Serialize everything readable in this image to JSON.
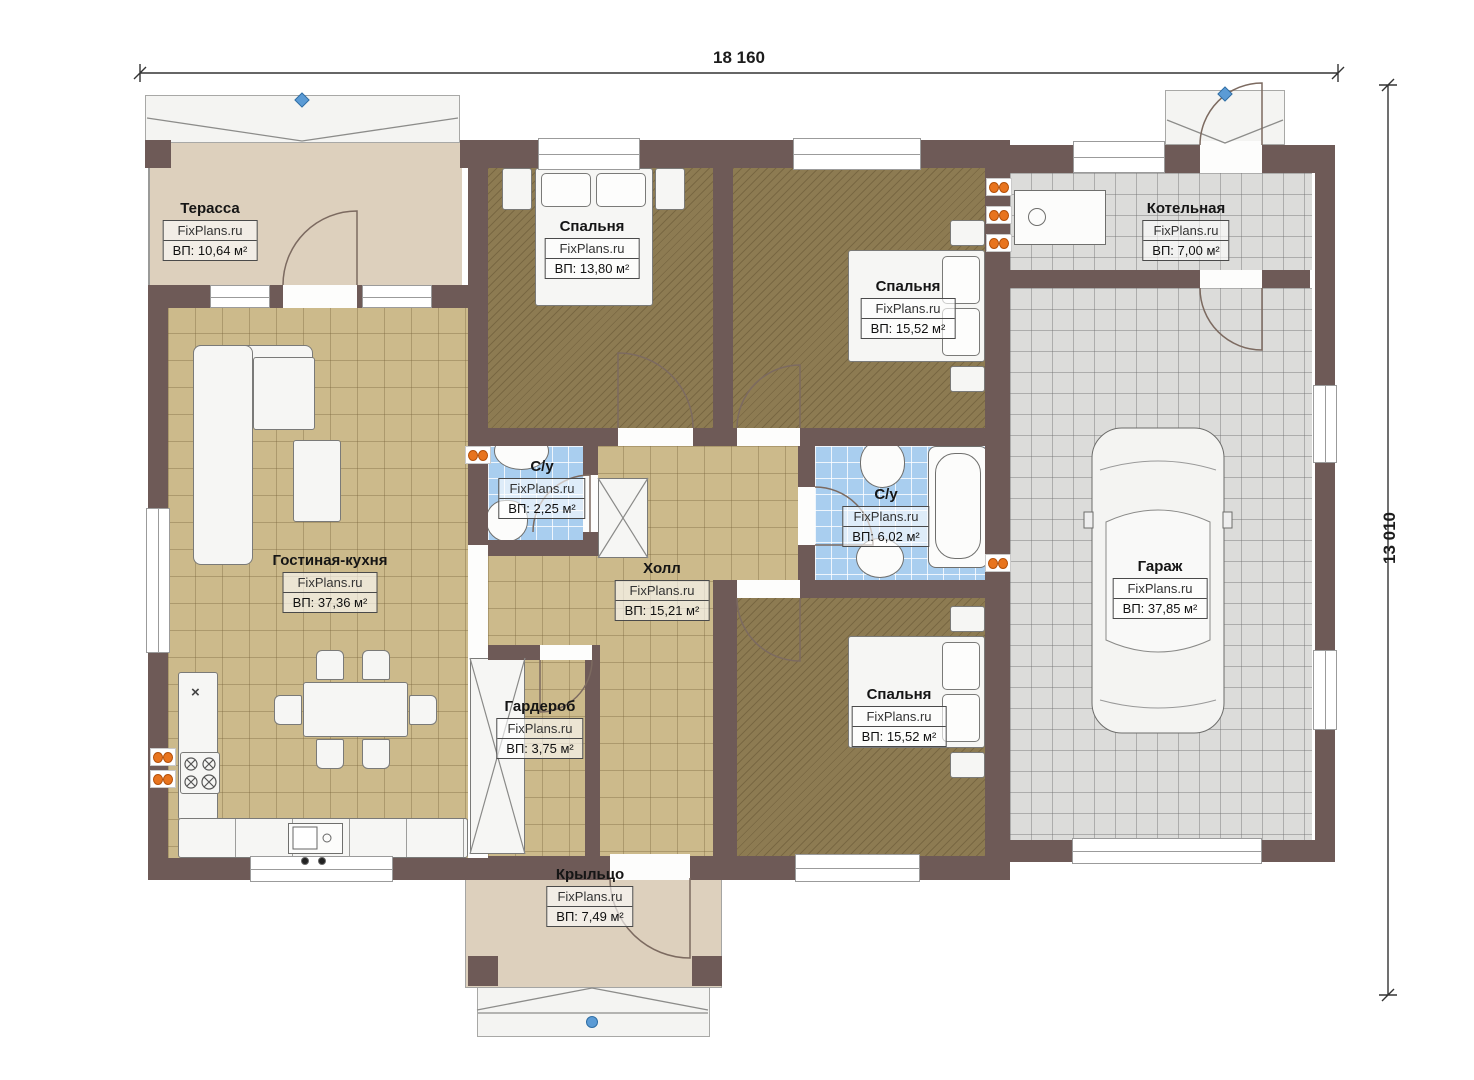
{
  "brand": "FixPlans.ru",
  "dimensions": {
    "width_label": "18 160",
    "height_label": "13 010"
  },
  "rooms": {
    "terrace": {
      "name": "Терасса",
      "area": "ВП: 10,64 м²"
    },
    "living": {
      "name": "Гостиная-кухня",
      "area": "ВП: 37,36 м²"
    },
    "bedroom1": {
      "name": "Спальня",
      "area": "ВП: 13,80 м²"
    },
    "bedroom2": {
      "name": "Спальня",
      "area": "ВП: 15,52 м²"
    },
    "boiler": {
      "name": "Котельная",
      "area": "ВП: 7,00 м²"
    },
    "garage": {
      "name": "Гараж",
      "area": "ВП: 37,85 м²"
    },
    "bath1": {
      "name": "С/у",
      "area": "ВП: 2,25 м²"
    },
    "hall": {
      "name": "Холл",
      "area": "ВП: 15,21 м²"
    },
    "bath2": {
      "name": "С/у",
      "area": "ВП: 6,02 м²"
    },
    "wardrobe": {
      "name": "Гардероб",
      "area": "ВП: 3,75 м²"
    },
    "bedroom3": {
      "name": "Спальня",
      "area": "ВП: 15,52 м²"
    },
    "porch": {
      "name": "Крыльцо",
      "area": "ВП: 7,49 м²"
    }
  },
  "symbols": {
    "kitchen_x": "×"
  },
  "colors": {
    "wall": "#6e5a57",
    "wood": "#ccba8b",
    "bedroom": "#8d7b52",
    "tile": "#dcdcda",
    "water": "#a9ceef",
    "terrace": "#ddd0bd",
    "accent_orange": "#e8741e",
    "marker_blue": "#5b9bd5"
  }
}
